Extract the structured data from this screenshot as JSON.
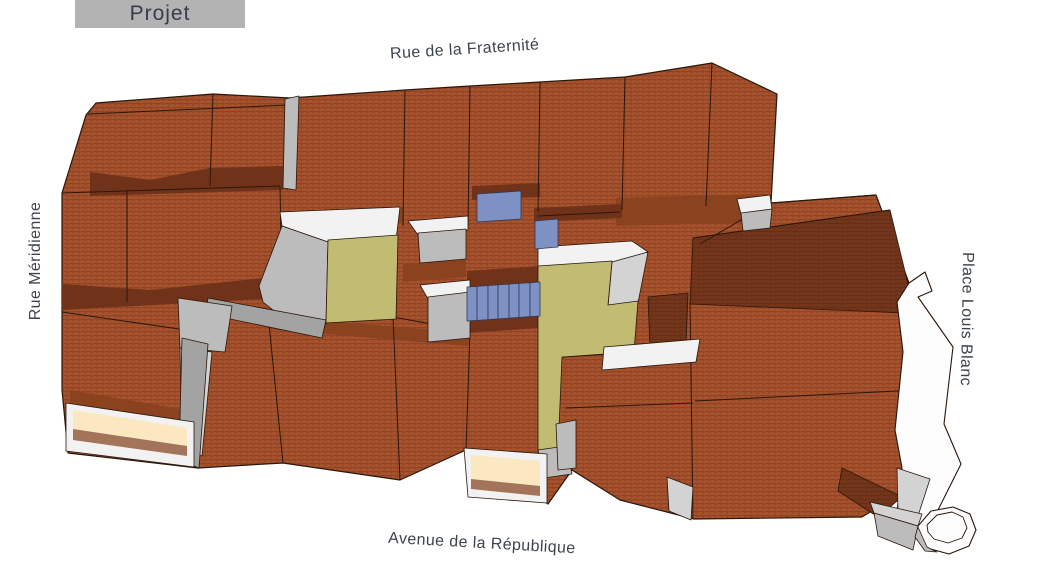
{
  "legend": {
    "title": "Projet"
  },
  "streets": {
    "top": "Rue de la Fraternité",
    "left": "Rue Méridienne",
    "right": "Place Louis Blanc",
    "bottom": "Avenue de la République"
  },
  "palette": {
    "outline": "#2a170b",
    "roof_base": "#a24f2c",
    "roof_speckle_dark": "#8a4123",
    "roof_speckle_light": "#b25b35",
    "roof_shadow_base": "#76361b",
    "roof_shadow_speckle": "#632c14",
    "roof_mid": "#8a421f",
    "roof_deep": "#70331a",
    "gray_wall": "#bcbcbc",
    "gray_light": "#d3d3d3",
    "gray_dark": "#a3a3a3",
    "white_wall": "#f2f2f2",
    "olive": "#c2bc72",
    "blue": "#7e91c4",
    "blue_outline": "#2f3a58",
    "cream": "#fbe7c0",
    "awning_brown": "#a3745a",
    "place_white": "#fdfdfd",
    "label_color": "#3e444b",
    "title_bg": "#b3b3b3",
    "title_color": "#363c4a"
  },
  "model": {
    "base": [
      {
        "n": "block-footprint",
        "f": "tex",
        "w": 1.2,
        "p": "96,103 213,94 290,98 405,90 470,86 540,82 625,77 712,63 777,94 771,203 876,195 909,283 906,315 938,389 927,477 862,517 694,519 620,500 572,470 548,504 466,450 400,480 283,463 198,468 68,453 62,390 62,193 86,115"
      },
      {
        "n": "shadow-topleft-hip",
        "f": "deep",
        "s": "none",
        "p": "90,172 150,180 210,168 283,166 283,190 90,196"
      },
      {
        "n": "shadow-row2",
        "f": "deep",
        "s": "none",
        "p": "62,284 150,290 282,276 282,298 62,310"
      },
      {
        "n": "shadow-topright",
        "f": "mid",
        "s": "none",
        "p": "616,198 768,194 766,222 616,226"
      },
      {
        "n": "dark-roof-face-right",
        "f": "texD",
        "p": "693,238 890,210 908,284 905,313 690,304"
      },
      {
        "n": "shadow-above-blue-rect",
        "f": "deep",
        "s": "none",
        "p": "472,186 540,183 540,197 472,200"
      },
      {
        "n": "shadow-roofF-bottom",
        "f": "deep",
        "s": "none",
        "p": "534,208 622,204 622,218 534,222"
      },
      {
        "n": "shadow-above-skylights",
        "f": "deep",
        "s": "none",
        "p": "467,271 540,266 540,285 467,290"
      },
      {
        "n": "shadow-below-skylights",
        "f": "deep",
        "s": "none",
        "p": "467,317 540,312 540,328 467,333"
      },
      {
        "n": "shadow-center-strip",
        "f": "mid",
        "s": "none",
        "p": "403,264 466,259 466,277 403,282"
      },
      {
        "n": "shadow-roofCD-bottom",
        "f": "mid",
        "s": "none",
        "p": "300,212 403,208 403,222 300,226"
      },
      {
        "n": "shadow-bottomrow-top",
        "f": "mid",
        "s": "none",
        "p": "268,316 470,333 468,346 268,329"
      },
      {
        "n": "shadow-bottomleft-eave",
        "f": "mid",
        "s": "none",
        "p": "70,390 186,410 188,427 70,407"
      },
      {
        "n": "dark-roof-fragment",
        "f": "texD",
        "p": "648,297 688,293 686,344 650,347"
      },
      {
        "n": "dark-corner-sliver",
        "f": "texD",
        "p": "842,468 902,497 878,517 838,491"
      }
    ],
    "lines": [
      {
        "n": "seam-top-1",
        "p": "213,94 210,186"
      },
      {
        "n": "seam-top-2",
        "p": "290,98 287,190"
      },
      {
        "n": "seam-top-3",
        "p": "405,90 403,226"
      },
      {
        "n": "seam-top-4",
        "p": "470,86 468,226"
      },
      {
        "n": "seam-top-5",
        "p": "540,82 538,212"
      },
      {
        "n": "seam-top-6",
        "p": "625,77 622,210"
      },
      {
        "n": "seam-top-7",
        "p": "712,63 706,206"
      },
      {
        "n": "seam-ridge-strip",
        "p": "88,114 288,105"
      },
      {
        "n": "seam-row2-top",
        "p": "62,193 280,186"
      },
      {
        "n": "seam-row2-right",
        "p": "280,186 282,296"
      },
      {
        "n": "seam-row2-mid",
        "p": "127,190 127,302"
      },
      {
        "n": "seam-row3-top",
        "p": "62,312 186,330"
      },
      {
        "n": "seam-bottomrow-top",
        "p": "180,344 232,310 268,314 393,317 470,331"
      },
      {
        "n": "seam-bottomrow-1",
        "p": "268,314 283,463"
      },
      {
        "n": "seam-bottomrow-2",
        "p": "393,317 400,480"
      },
      {
        "n": "seam-bottomrow-3",
        "p": "470,331 466,450"
      },
      {
        "n": "seam-right-fold",
        "p": "693,238 890,210"
      },
      {
        "n": "seam-right-band",
        "p": "771,203 876,195"
      },
      {
        "n": "seam-right-hip",
        "p": "770,203 700,244"
      },
      {
        "n": "seam-right-vertical",
        "p": "690,302 693,518"
      },
      {
        "n": "seam-right-ridge",
        "p": "695,401 937,389"
      },
      {
        "n": "seam-midrow-top",
        "p": "562,357 695,349"
      },
      {
        "n": "seam-midrow",
        "p": "566,408 693,403"
      },
      {
        "n": "seam-roofF-bottom",
        "p": "538,216 620,212"
      }
    ],
    "overlays": [
      {
        "n": "gray-band-topleft",
        "f": "gray",
        "p": "285,99 299,96 296,190 283,188"
      },
      {
        "n": "courtyard1-wall-top",
        "f": "white",
        "p": "280,212 400,207 396,240 328,242 282,226"
      },
      {
        "n": "courtyard1-wall-left",
        "f": "gray",
        "p": "282,226 328,242 326,324 298,330 263,302 259,286"
      },
      {
        "n": "courtyard1-ledge",
        "f": "grayD",
        "p": "208,298 326,320 322,338 206,314"
      },
      {
        "n": "courtyard1-floor",
        "f": "olive",
        "p": "328,240 398,235 396,319 326,323"
      },
      {
        "n": "gray-wall-west-upper",
        "f": "gray",
        "p": "178,298 232,306 225,352 180,348"
      },
      {
        "n": "gray-wall-west-lower",
        "f": "grayL",
        "p": "180,348 212,352 202,456 182,450"
      },
      {
        "n": "dormer-upper-white",
        "f": "white",
        "p": "408,221 468,216 468,230 418,235"
      },
      {
        "n": "dormer-upper-gray",
        "f": "gray",
        "p": "418,233 466,229 466,259 420,263"
      },
      {
        "n": "dormer-lower-white",
        "f": "white",
        "p": "420,285 470,280 470,294 428,299"
      },
      {
        "n": "dormer-lower-gray",
        "f": "gray",
        "p": "428,297 470,292 470,338 428,342"
      },
      {
        "n": "courtyard2-wall-top",
        "f": "white",
        "p": "538,247 632,241 648,252 612,263 538,270"
      },
      {
        "n": "courtyard2-wall-right",
        "f": "grayL",
        "p": "612,262 648,252 638,303 608,306"
      },
      {
        "n": "courtyard2-floor",
        "f": "olive",
        "p": "538,266 612,261 608,305 638,301 634,352 562,357 558,452 538,456"
      },
      {
        "n": "courtyard2-wall-bottom",
        "f": "white",
        "p": "604,347 700,339 696,362 602,370"
      },
      {
        "n": "courtyard2-end-wall",
        "f": "gray",
        "p": "538,450 566,446 572,474 544,478"
      },
      {
        "n": "gray-firewall-left",
        "f": "grayD",
        "p": "182,338 208,344 199,468 179,460"
      },
      {
        "n": "gray-wall-center",
        "f": "gray",
        "p": "556,424 576,420 576,468 558,470"
      },
      {
        "n": "gray-sliver-bottomright",
        "f": "grayL",
        "p": "667,477 693,487 691,520 669,511"
      },
      {
        "n": "fold-bit-white",
        "f": "white",
        "p": "737,199 770,195 772,210 741,214"
      },
      {
        "n": "fold-bit-gray",
        "f": "gray",
        "p": "741,213 772,209 770,228 743,231"
      },
      {
        "n": "blue-roof-rect",
        "f": "blue",
        "s": "#2f3a58",
        "p": "477,194 521,191 521,219 477,222"
      },
      {
        "n": "blue-roof-square",
        "f": "blue",
        "s": "#2f3a58",
        "p": "535,221 558,219 558,247 535,249"
      },
      {
        "n": "skylight-slat-1",
        "f": "blue",
        "s": "#2f3a58",
        "p": "467,287 477,286.4 477,320.4 467,321"
      },
      {
        "n": "skylight-slat-2",
        "f": "blue",
        "s": "#2f3a58",
        "p": "477,286.4 488,285.6 488,319.6 477,320.4"
      },
      {
        "n": "skylight-slat-3",
        "f": "blue",
        "s": "#2f3a58",
        "p": "488,285.6 498,284.9 498,318.9 488,319.6"
      },
      {
        "n": "skylight-slat-4",
        "f": "blue",
        "s": "#2f3a58",
        "p": "498,284.9 509,284.1 509,318.1 498,318.9"
      },
      {
        "n": "skylight-slat-5",
        "f": "blue",
        "s": "#2f3a58",
        "p": "509,284.1 519,283.4 519,317.4 509,318.1"
      },
      {
        "n": "skylight-slat-6",
        "f": "blue",
        "s": "#2f3a58",
        "p": "519,283.4 530,282.7 530,316.7 519,317.4"
      },
      {
        "n": "skylight-slat-7",
        "f": "blue",
        "s": "#2f3a58",
        "p": "530,282.7 540,282 540,316 530,316.7"
      },
      {
        "n": "place-curb-strip",
        "f": "placeW",
        "w": 1.1,
        "p": "909,283 925,272 932,291 918,297 953,347 944,424 961,464 938,510 916,538 896,521 902,468 895,430 903,352 897,302"
      },
      {
        "n": "place-curb-shade",
        "f": "grayL",
        "p": "897,468 930,479 917,519 898,512"
      },
      {
        "n": "kiosk-connector-top",
        "f": "grayL",
        "p": "870,502 922,514 918,526 874,513"
      },
      {
        "n": "kiosk-connector",
        "f": "gray",
        "p": "874,513 918,526 913,550 878,536"
      },
      {
        "n": "kiosk-octagon-outer",
        "f": "placeW",
        "w": 1.1,
        "p": "918,526 931,511 953,507 970,514 976,530 969,546 949,554 927,548 918,538"
      },
      {
        "n": "kiosk-octagon-shade",
        "f": "gray",
        "p": "918,527 927,547 937,552 925,551 915,537"
      },
      {
        "n": "kiosk-octagon-inner",
        "f": "placeW",
        "w": 0.9,
        "p": "927,525 937,515 952,512 963,517 967,528 962,538 948,543 934,539 928,532"
      },
      {
        "n": "shopfront-left-frame",
        "f": "white",
        "p": "66,403 194,422 194,467 66,451"
      },
      {
        "n": "shopfront-left-cream",
        "f": "cream",
        "s": "none",
        "p": "73,410 187,428 187,446 73,429"
      },
      {
        "n": "shopfront-left-brown",
        "f": "brown",
        "s": "none",
        "p": "73,429 187,446 187,456 73,440"
      },
      {
        "n": "shopfront-center-frame",
        "f": "white",
        "p": "464,448 547,454 547,503 468,497"
      },
      {
        "n": "shopfront-center-cream",
        "f": "cream",
        "s": "none",
        "p": "471,455 540,461 540,486 471,479"
      },
      {
        "n": "shopfront-center-brown",
        "f": "brown",
        "s": "none",
        "p": "471,479 540,486 540,496 471,489"
      }
    ]
  }
}
